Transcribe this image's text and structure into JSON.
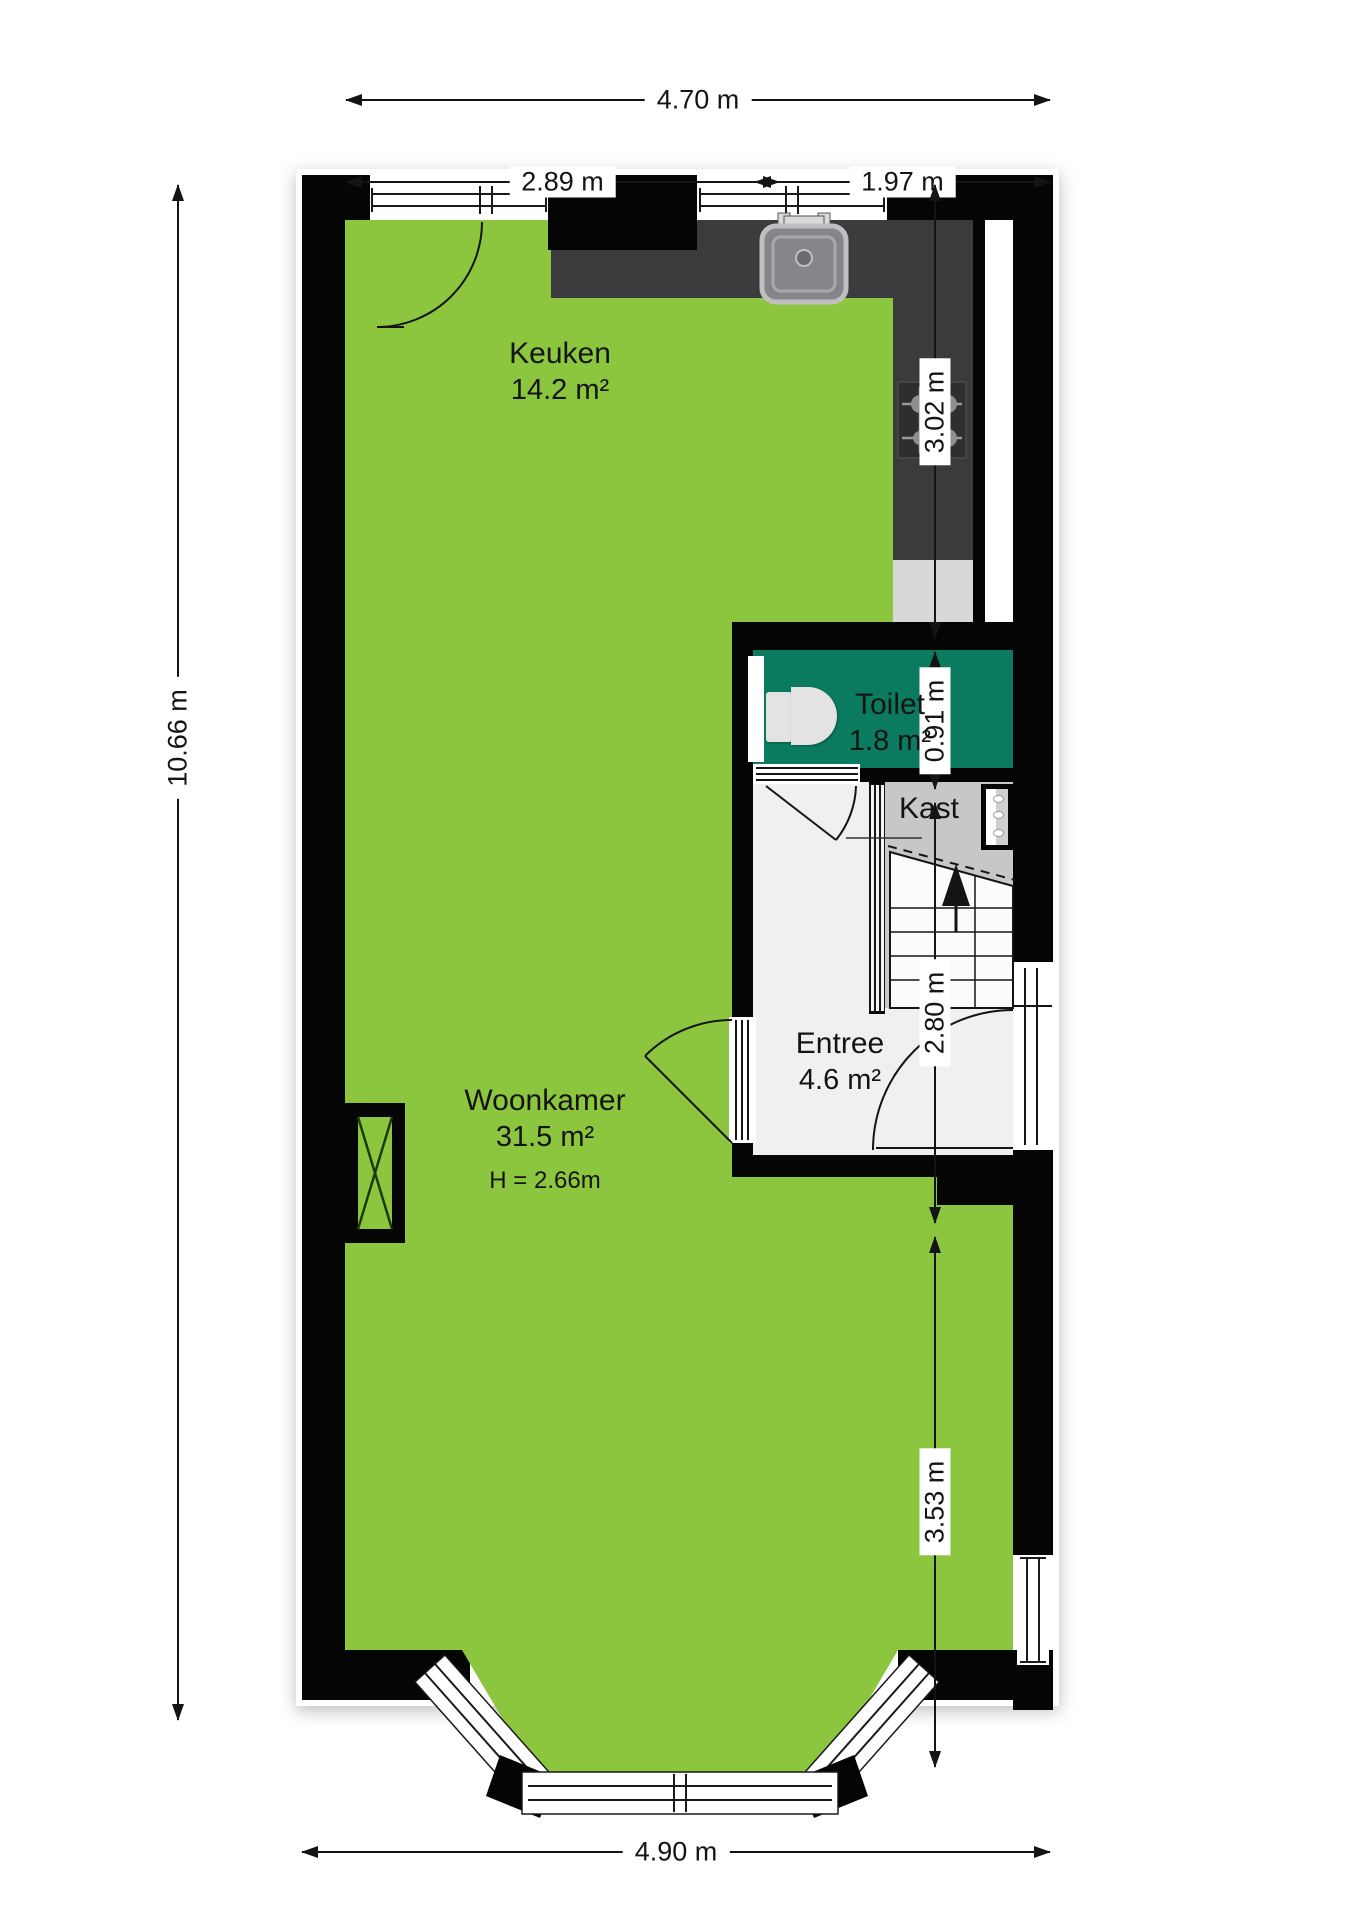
{
  "plan": {
    "title": "Floor plan - begane grond",
    "rooms": {
      "keuken": {
        "name": "Keuken",
        "area": "14.2 m²"
      },
      "toilet": {
        "name": "Toilet",
        "area": "1.8 m²"
      },
      "kast": {
        "name": "Kast"
      },
      "entree": {
        "name": "Entree",
        "area": "4.6 m²"
      },
      "woonkamer": {
        "name": "Woonkamer",
        "area": "31.5 m²",
        "ceiling_height": "H = 2.66m"
      }
    },
    "dimensions": {
      "top_total": "4.70 m",
      "top_left": "2.89 m",
      "top_right": "1.97 m",
      "left_total": "10.66 m",
      "right_kitchen": "3.02 m",
      "right_toilet": "0.91 m",
      "right_entree": "2.80 m",
      "right_living": "3.53 m",
      "bottom_total": "4.90 m"
    },
    "colors": {
      "floor_green": "#8CC63F",
      "toilet_teal": "#0B7B5F",
      "wall_black": "#050505",
      "counter_dark": "#3B3B3D",
      "entree_floor": "#F1F0EF",
      "kast_floor": "#C7C7C7",
      "fixture_gray": "#E3E3E3"
    },
    "fixtures": [
      "kitchen-sink",
      "gas-hob",
      "toilet",
      "staircase-up",
      "boiler",
      "flue-shaft",
      "bay-window"
    ]
  }
}
